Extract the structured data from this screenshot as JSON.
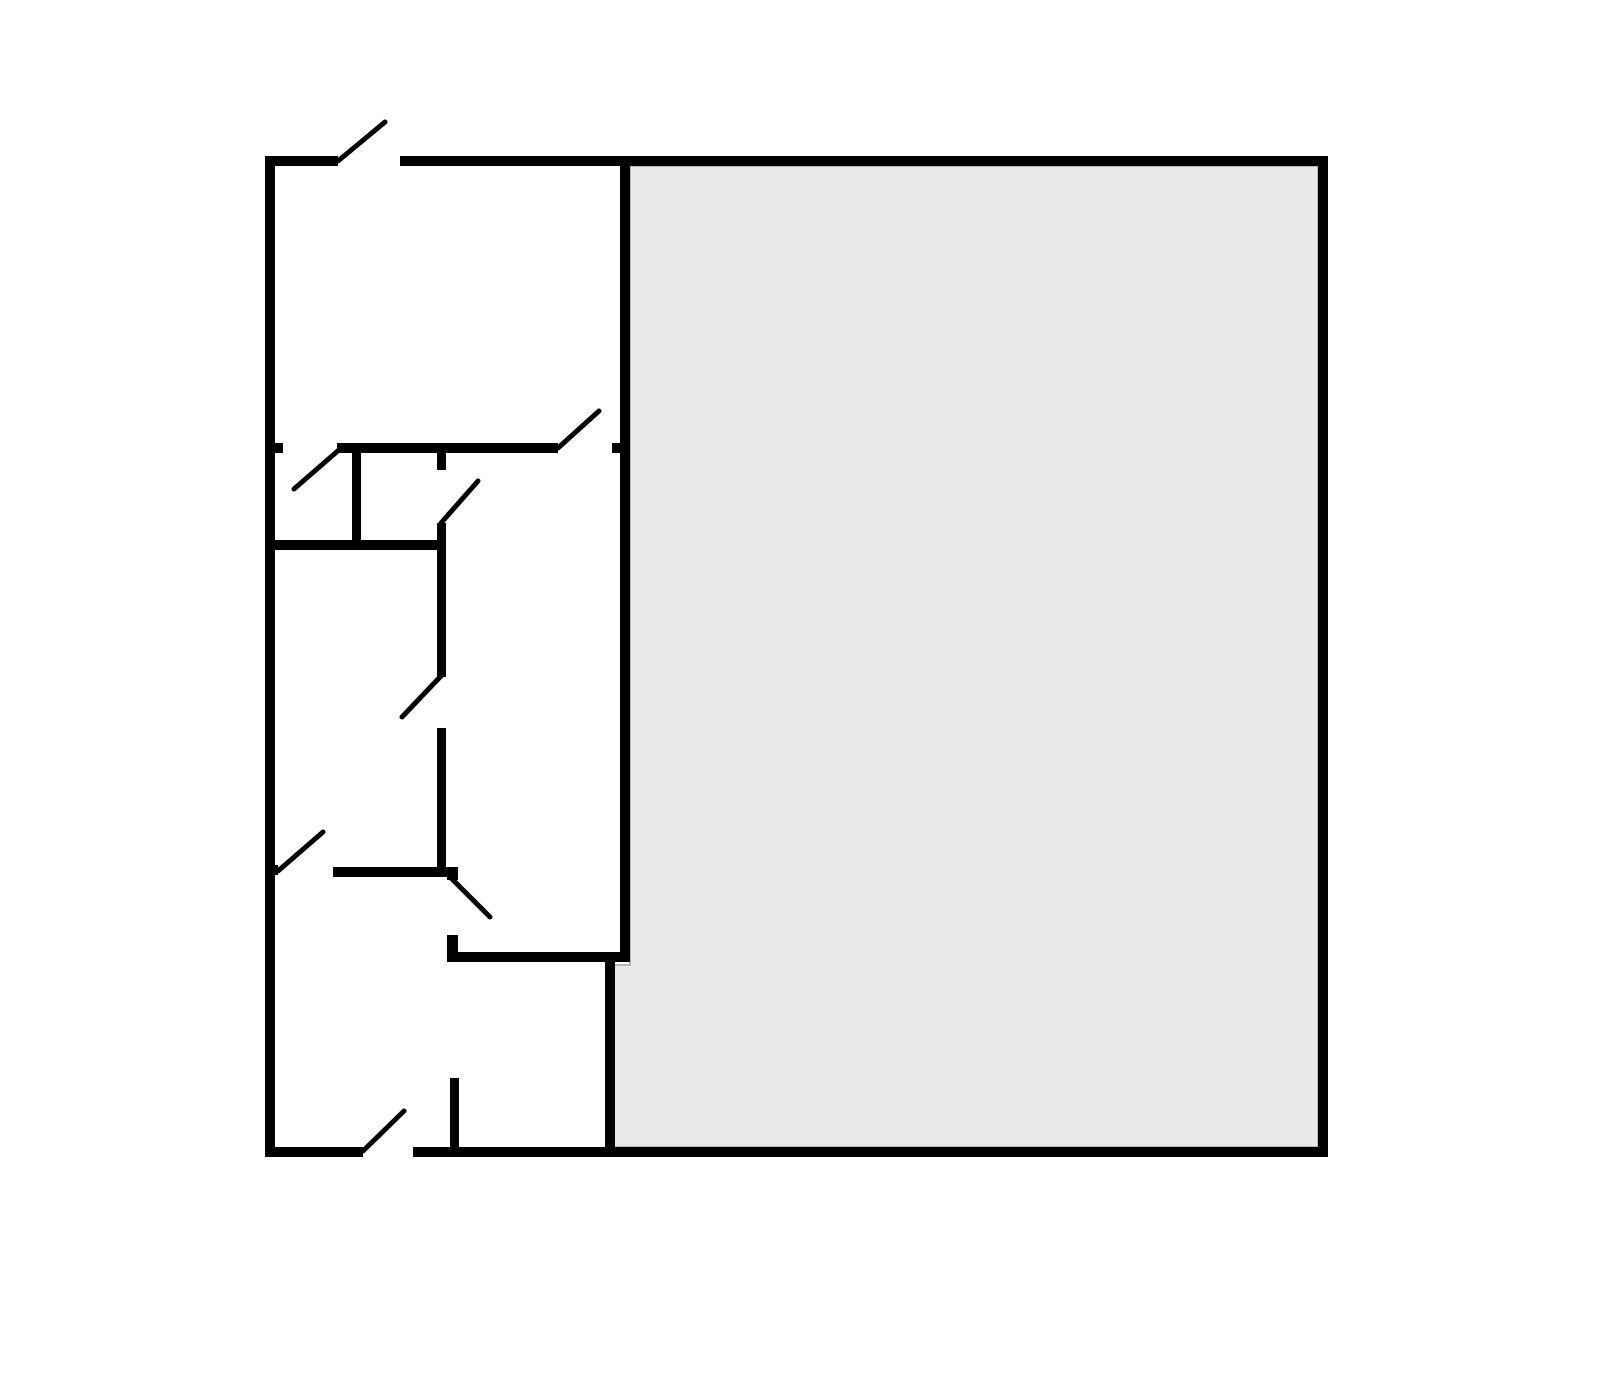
{
  "diagram": {
    "type": "floor-plan",
    "canvas": {
      "width": 1600,
      "height": 1381,
      "background": "#ffffff"
    },
    "colors": {
      "wall": "#000000",
      "door": "#000000",
      "shaded_fill": "#e9e9e9",
      "shaded_edge": "#a8a8a8"
    },
    "shaded_region": {
      "name": "large-room-shaded",
      "points": [
        [
          630,
          166
        ],
        [
          1318,
          166
        ],
        [
          1318,
          1147
        ],
        [
          613,
          1147
        ],
        [
          613,
          965
        ],
        [
          630,
          965
        ]
      ]
    },
    "walls": [
      {
        "name": "outer-top-left",
        "x": 265,
        "y": 156,
        "w": 73,
        "h": 10
      },
      {
        "name": "outer-top-main",
        "x": 400,
        "y": 156,
        "w": 928,
        "h": 10
      },
      {
        "name": "outer-bottom-left",
        "x": 265,
        "y": 1147,
        "w": 98,
        "h": 10
      },
      {
        "name": "outer-bottom-main",
        "x": 413,
        "y": 1147,
        "w": 915,
        "h": 10
      },
      {
        "name": "outer-left",
        "x": 265,
        "y": 156,
        "w": 10,
        "h": 1001
      },
      {
        "name": "outer-right",
        "x": 1318,
        "y": 156,
        "w": 10,
        "h": 1001
      },
      {
        "name": "center-divider-vertical",
        "x": 620,
        "y": 156,
        "w": 10,
        "h": 806
      },
      {
        "name": "upper-divider-left-stub",
        "x": 265,
        "y": 443,
        "w": 18,
        "h": 10
      },
      {
        "name": "upper-divider-mid",
        "x": 337,
        "y": 443,
        "w": 221,
        "h": 10
      },
      {
        "name": "upper-divider-right-stub",
        "x": 612,
        "y": 443,
        "w": 18,
        "h": 10
      },
      {
        "name": "closet-vertical",
        "x": 352,
        "y": 453,
        "w": 9,
        "h": 94
      },
      {
        "name": "mid-left-horizontal",
        "x": 265,
        "y": 540,
        "w": 181,
        "h": 10
      },
      {
        "name": "hall-vertical-top-stub",
        "x": 437,
        "y": 453,
        "w": 9,
        "h": 17
      },
      {
        "name": "hall-vertical-mid",
        "x": 437,
        "y": 523,
        "w": 9,
        "h": 154
      },
      {
        "name": "hall-vertical-low",
        "x": 437,
        "y": 728,
        "w": 9,
        "h": 149
      },
      {
        "name": "lower-left-horizontal",
        "x": 333,
        "y": 867,
        "w": 125,
        "h": 10
      },
      {
        "name": "lower-corner-piece",
        "x": 447,
        "y": 867,
        "w": 11,
        "h": 13
      },
      {
        "name": "lower-left-wall-stub",
        "x": 265,
        "y": 865,
        "w": 13,
        "h": 10
      },
      {
        "name": "lower-hall-stub",
        "x": 447,
        "y": 935,
        "w": 11,
        "h": 27
      },
      {
        "name": "step-horizontal",
        "x": 450,
        "y": 952,
        "w": 180,
        "h": 10
      },
      {
        "name": "lower-divider-vertical",
        "x": 605,
        "y": 955,
        "w": 10,
        "h": 202
      },
      {
        "name": "bottom-room-stub",
        "x": 450,
        "y": 1078,
        "w": 9,
        "h": 79
      }
    ],
    "doors": [
      {
        "name": "top-entry",
        "x1": 338,
        "y1": 161,
        "x2": 385,
        "y2": 122
      },
      {
        "name": "closet",
        "x1": 340,
        "y1": 449,
        "x2": 294,
        "y2": 489
      },
      {
        "name": "upper-room",
        "x1": 558,
        "y1": 448,
        "x2": 599,
        "y2": 411
      },
      {
        "name": "hall-upper",
        "x1": 441,
        "y1": 523,
        "x2": 478,
        "y2": 481
      },
      {
        "name": "hall-lower",
        "x1": 441,
        "y1": 676,
        "x2": 402,
        "y2": 717
      },
      {
        "name": "mid-left-room",
        "x1": 278,
        "y1": 871,
        "x2": 323,
        "y2": 832
      },
      {
        "name": "lower-hall",
        "x1": 452,
        "y1": 879,
        "x2": 490,
        "y2": 917
      },
      {
        "name": "bottom-entry",
        "x1": 363,
        "y1": 1151,
        "x2": 404,
        "y2": 1111
      }
    ],
    "style": {
      "wall_thickness": 10,
      "door_stroke": 5
    }
  }
}
